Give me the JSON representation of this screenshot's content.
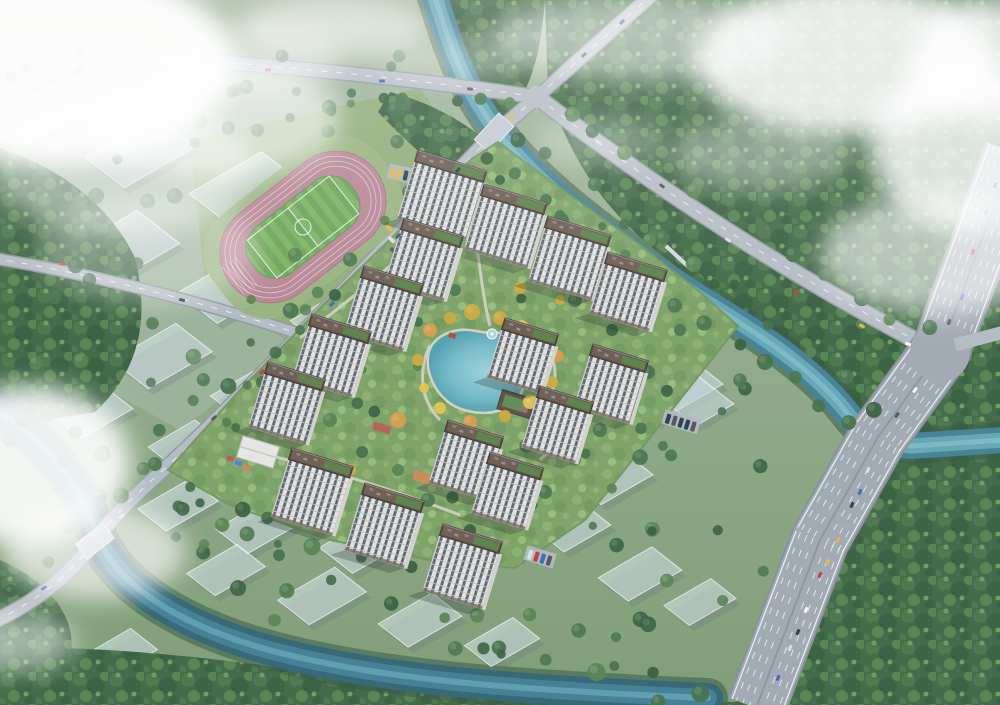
{
  "meta": {
    "type": "architectural-aerial-rendering",
    "description": "Bird's-eye view rendering of a riverside residential compound: high-rise towers around a central landscaped lake with fountain, a pink running track with football field to the northwest, two teal rivers with bridges, tree-lined avenues, a wide multi-lane expressway on the east, translucent future-development massing blocks, and drifting white clouds.",
    "canvas": {
      "width": 1000,
      "height": 705
    }
  },
  "scene": {
    "counts": {
      "residential_towers": 16,
      "ghost_massing_blocks": 28,
      "rivers": 2,
      "road_bridges": 2,
      "footbridges": 1,
      "parking_lots": 3,
      "playgrounds": 2
    },
    "features": {
      "central_lake": true,
      "fountain": true,
      "lakeside_pavilion": true,
      "clubhouse": true,
      "kindergarten": true,
      "running_track": true,
      "football_field": true,
      "expressway": true,
      "clouds": true
    },
    "roads": [
      "north-avenue",
      "riverside-avenue",
      "site-boundary-road",
      "west-connector",
      "expressway"
    ]
  },
  "colors": {
    "baseTop": "#a3b697",
    "baseBottom": "#7d9b6f",
    "district": "#9db397",
    "lawn": "#8fac72",
    "apron": "#9ab37a",
    "forest": "#3c633c",
    "forestMid": "#477244",
    "forestDark": "#335a36",
    "forestLight": "#538048",
    "forestHi": "#6b9a58",
    "water": "#3f7e92",
    "waterMid": "#67abb9",
    "waterHi": "#8cc7cf",
    "waterDeep": "#2c6070",
    "bank": "#2e523b",
    "lakeCenter": "#9ad4d8",
    "lakeMid": "#74bcc8",
    "lakeDeep": "#4f9fb0",
    "lakeEdge": "#d9d4be",
    "fountain": "#aed6da",
    "pavilion": "#b0452f",
    "road": "#b7bcc2",
    "roadEdge": "#8f969c",
    "highway": "#a2a8af",
    "highwayEdge": "#878d94",
    "marking": "#ffffff",
    "trackPink": "#bb8290",
    "trackRim": "#a8707e",
    "fieldA": "#6ba24f",
    "fieldB": "#79b25b",
    "siteGreen": "#7ca15e",
    "siteLight": "#8bb069",
    "path": "#d8d3c3",
    "towerFacade": "#e9e7e1",
    "towerWindow": "#59606b",
    "towerFloor": "#c5c2ba",
    "towerRoof": "#55423a",
    "towerRoofIn": "#6b5648",
    "towerRoofEdge": "#3a2d27",
    "roofGarden": "#567f3f",
    "towerEnd": "#d8d5cd",
    "plinth": "#7a6a5c",
    "shadow": "rgba(25,35,28,0.28)",
    "treeYellow": "#e8c544",
    "treeYellowDark": "#d3a832",
    "treeOrange": "#dd9b3f",
    "ghostFill": "rgba(226,238,241,0.52)",
    "ghostEdge": "rgba(255,255,255,0.7)",
    "ghostShadow": "rgba(90,110,115,0.25)",
    "cloud": "#ffffff",
    "hazeTint": "rgba(170,200,225,0.09)",
    "playRed": "#c05548",
    "playOrange": "#d9824a",
    "playBlue": "#4a7fd9",
    "clubRoof": "#5e4a3e",
    "kgRoof": "#ece9e4",
    "carColors": [
      "#ffffff",
      "#dfe3e6",
      "#3a62b8",
      "#24354d",
      "#c23434",
      "#e8b83a",
      "#4d4d55"
    ]
  }
}
